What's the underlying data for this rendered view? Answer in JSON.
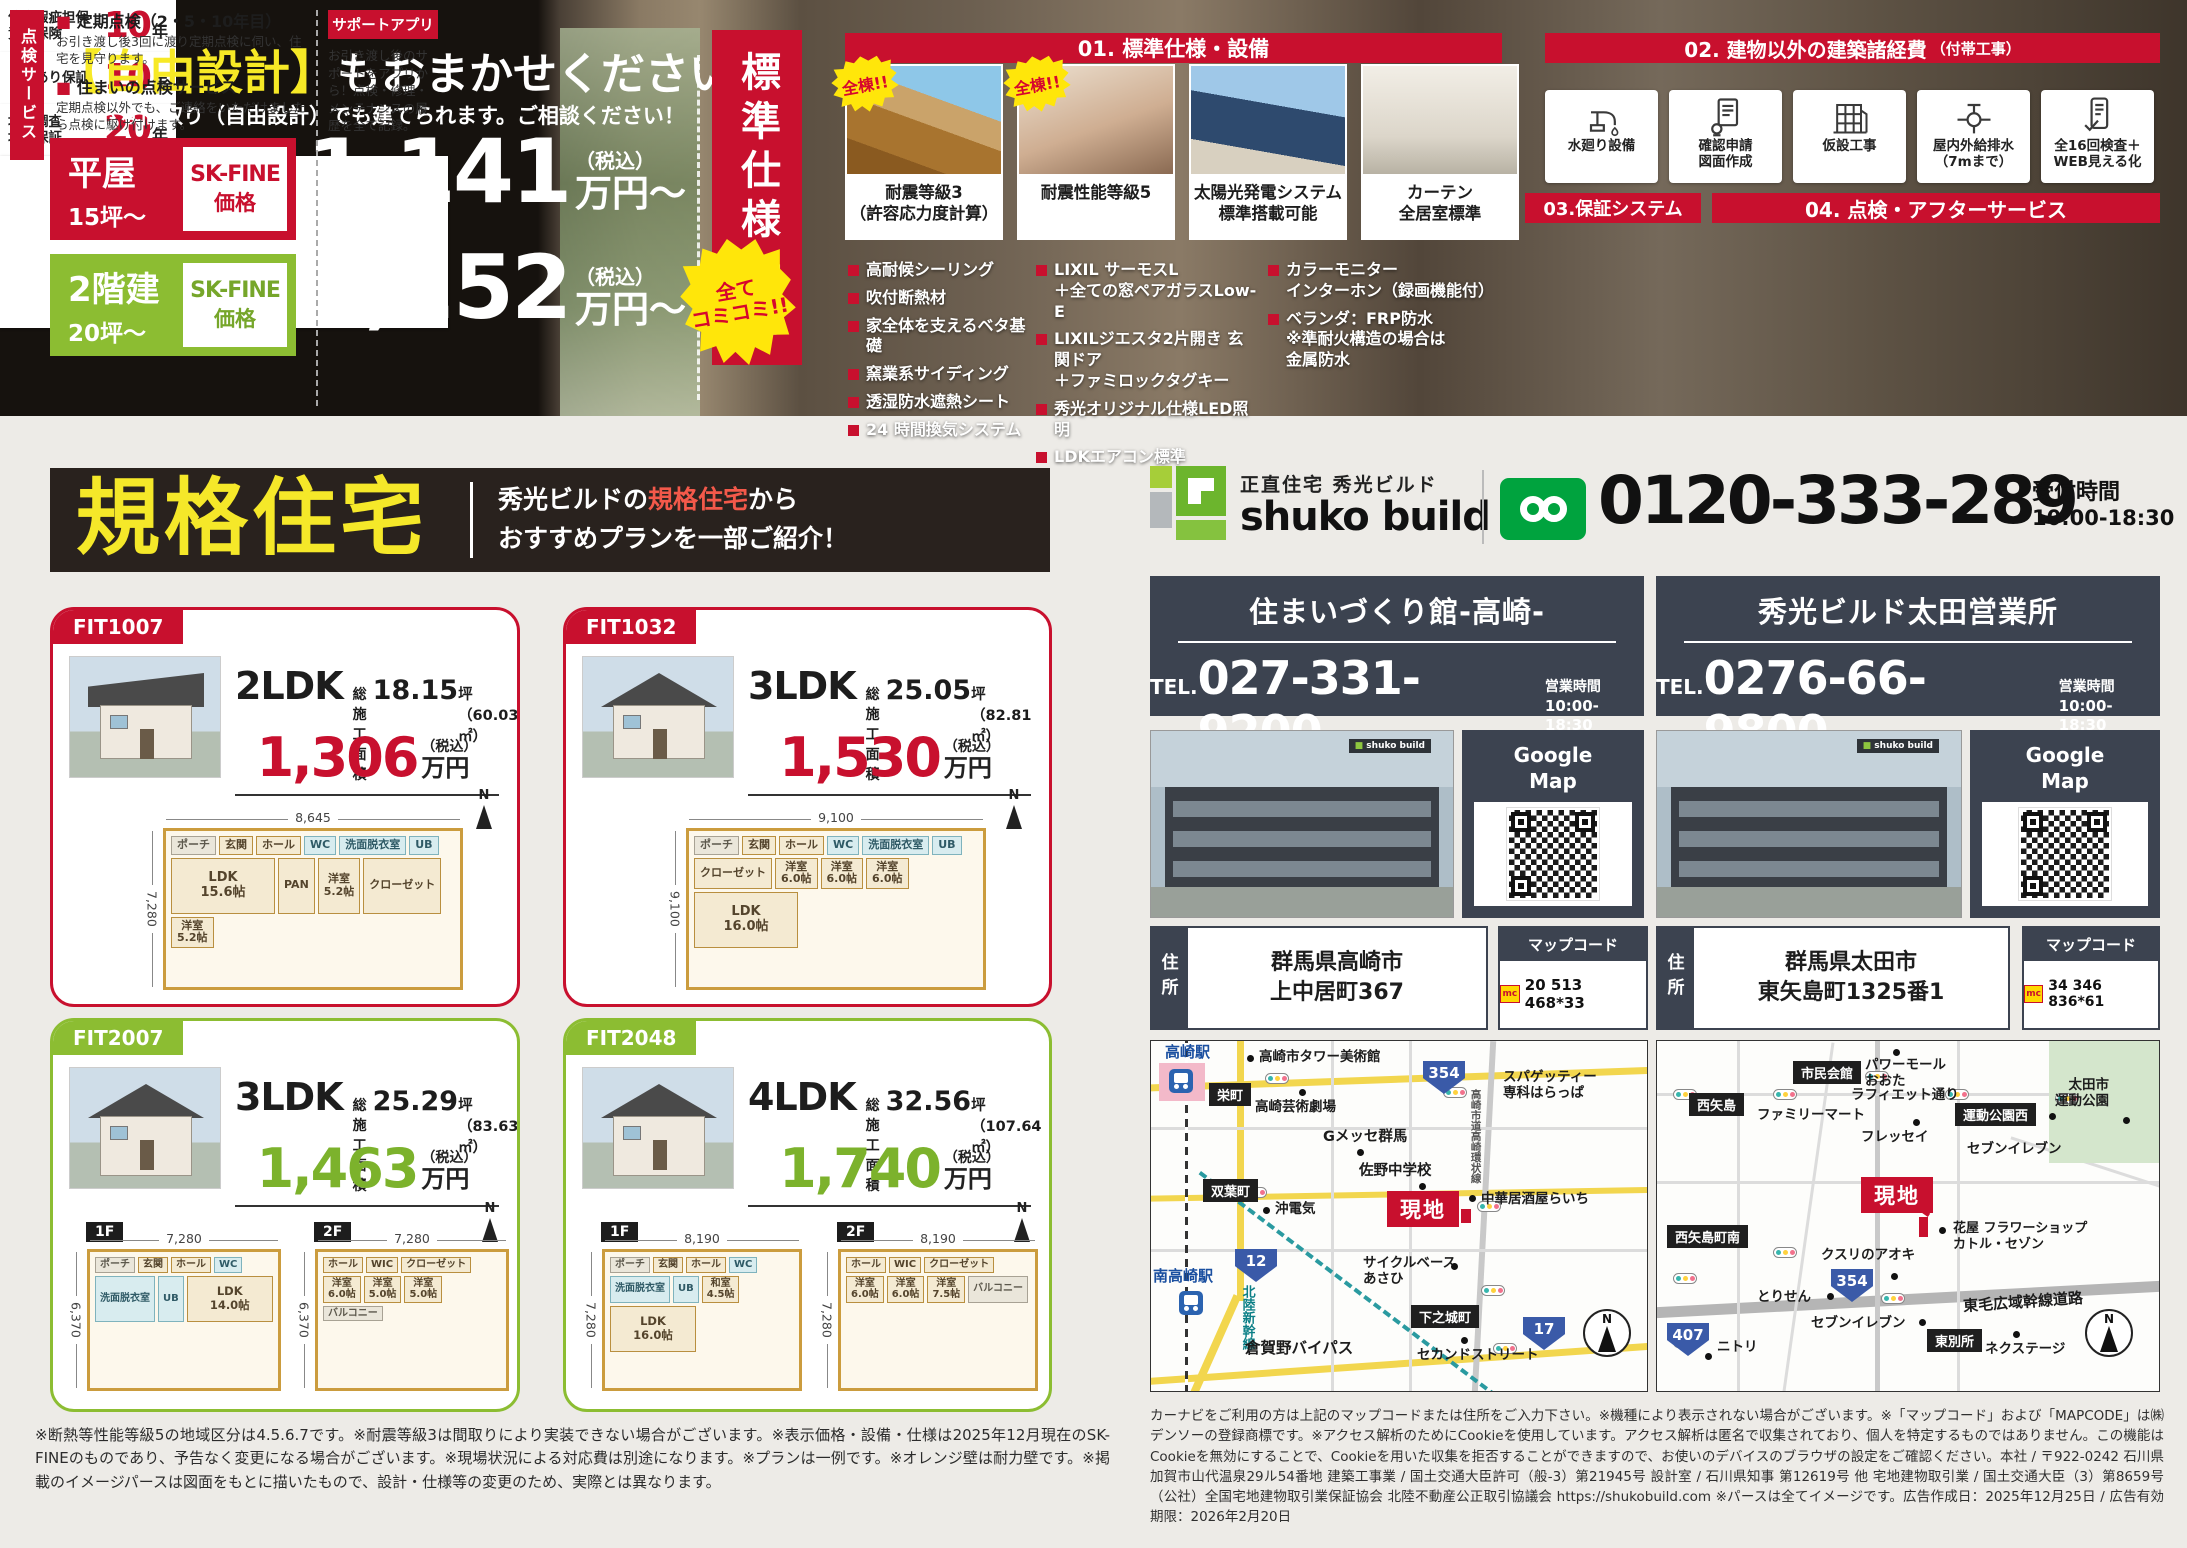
{
  "top": {
    "free_design": {
      "title_highlight": "【自由設計】",
      "title_rest": "もおまかせください。",
      "subtitle": "お好きな間取り（自由設計）でも建てられます。ご相談ください！",
      "rows": [
        {
          "name": "平屋",
          "size": "15坪〜",
          "badge": "SK-FINE",
          "badge_sub": "価格",
          "price": "1,141",
          "tax": "（税込）",
          "unit": "万円〜"
        },
        {
          "name": "2階建",
          "size": "20坪〜",
          "badge": "SK-FINE",
          "badge_sub": "価格",
          "price": "1,252",
          "tax": "（税込）",
          "unit": "万円〜"
        }
      ]
    },
    "std_banner": {
      "label": "標準仕様一覧",
      "bubble": "全て\nコミコミ!!"
    },
    "sec01": {
      "title": "01. 標準仕様・設備",
      "cards": [
        {
          "bubble": "全棟!!",
          "caption": "耐震等級3\n（許容応力度計算）"
        },
        {
          "bubble": "全棟!!",
          "caption": "耐震性能等級5"
        },
        {
          "caption": "太陽光発電システム\n標準搭載可能"
        },
        {
          "caption": "カーテン\n全居室標準"
        }
      ],
      "spec_columns": [
        [
          "高耐候シーリング",
          "吹付断熱材",
          "家全体を支えるベタ基礎",
          "窯業系サイディング",
          "透湿防水遮熱シート",
          "24 時間換気システム"
        ],
        [
          "LIXIL サーモスL\n＋全ての窓ペアガラスLow-E",
          "LIXILジエスタ2片開き 玄関ドア\n＋ファミロックタグキー",
          "秀光オリジナル仕様LED照明",
          "LDKエアコン標準"
        ],
        [
          "カラーモニター\nインターホン（録画機能付）",
          "ベランダ：FRP防水\n※準耐火構造の場合は\n金属防水"
        ]
      ]
    },
    "sec02": {
      "title": "02. 建物以外の建築諸経費",
      "title_sub": "（付帯工事）",
      "items": [
        {
          "icon": "faucet-icon",
          "label": "水廻り設備"
        },
        {
          "icon": "blueprint-icon",
          "label": "確認申請\n図面作成"
        },
        {
          "icon": "scaffold-icon",
          "label": "仮設工事"
        },
        {
          "icon": "plumbing-icon",
          "label": "屋内外給排水\n（7mまで）"
        },
        {
          "icon": "inspection-icon",
          "label": "全16回検査＋\nWEB見える化"
        }
      ]
    },
    "sec03": {
      "title": "03.保証システム",
      "rows": [
        {
          "label": "住宅瑕疵担保\n責任保険",
          "years": "10",
          "unit": "年"
        },
        {
          "label": "しろあり保証",
          "years": "10",
          "unit": "年"
        },
        {
          "label": "地盤調査\n地盤保証",
          "years": "20",
          "unit": "年"
        }
      ]
    },
    "sec04": {
      "title": "04. 点検・アフターサービス",
      "vertical_label": "点検サービス",
      "item1_title": "定期点検（2・5・10年目）",
      "item1_desc": "お引き渡し後3回に渡り定期点検に伺い、住宅を見守ります。",
      "item2_title": "住まいの点検サービス",
      "item2_desc": "定期点検以外でも、ご連絡をいただけましたら点検に駆け付けます。",
      "app_badge": "サポートアプリ",
      "app_desc": "お引き渡し後のサポートをアプリから！点検・修理・メンテナンスの履歴を全て記録。"
    }
  },
  "kikaku": {
    "title": "規格住宅",
    "desc_pre": "秀光ビルドの",
    "desc_highlight": "規格住宅",
    "desc_post": "から",
    "desc_line2": "おすすめプランを一部ご紹介！"
  },
  "plans": [
    {
      "code": "FIT1007",
      "ldk": "2LDK",
      "area_label": "総施工面積",
      "area_value": "18.15",
      "area_unit": "坪（60.03㎡）",
      "price": "1,306",
      "tax": "（税込）",
      "unit": "万円",
      "floors": [
        {
          "name": "",
          "width": "8,645",
          "height": "7,280",
          "rooms": [
            "ポーチ",
            "玄関",
            "ホール",
            "WC",
            "洗面脱衣室",
            "UB",
            "LDK\n15.6帖",
            "PAN",
            "洋室\n5.2帖",
            "クローゼット",
            "洋室\n5.2帖"
          ]
        }
      ]
    },
    {
      "code": "FIT1032",
      "ldk": "3LDK",
      "area_label": "総施工面積",
      "area_value": "25.05",
      "area_unit": "坪（82.81㎡）",
      "price": "1,530",
      "tax": "（税込）",
      "unit": "万円",
      "floors": [
        {
          "name": "",
          "width": "9,100",
          "height": "9,100",
          "rooms": [
            "ポーチ",
            "玄関",
            "ホール",
            "WC",
            "洗面脱衣室",
            "UB",
            "クローゼット",
            "洋室\n6.0帖",
            "洋室\n6.0帖",
            "洋室\n6.0帖",
            "LDK\n16.0帖"
          ]
        }
      ]
    },
    {
      "code": "FIT2007",
      "ldk": "3LDK",
      "area_label": "総施工面積",
      "area_value": "25.29",
      "area_unit": "坪（83.63㎡）",
      "price": "1,463",
      "tax": "（税込）",
      "unit": "万円",
      "floors": [
        {
          "name": "1F",
          "width": "7,280",
          "height": "6,370",
          "rooms": [
            "ポーチ",
            "玄関",
            "ホール",
            "WC",
            "洗面脱衣室",
            "UB",
            "LDK\n14.0帖"
          ]
        },
        {
          "name": "2F",
          "width": "7,280",
          "height": "6,370",
          "rooms": [
            "ホール",
            "WIC",
            "クローゼット",
            "洋室\n6.0帖",
            "洋室\n5.0帖",
            "洋室\n5.0帖",
            "バルコニー"
          ]
        }
      ]
    },
    {
      "code": "FIT2048",
      "ldk": "4LDK",
      "area_label": "総施工面積",
      "area_value": "32.56",
      "area_unit": "坪（107.64㎡）",
      "price": "1,740",
      "tax": "（税込）",
      "unit": "万円",
      "floors": [
        {
          "name": "1F",
          "width": "8,190",
          "height": "7,280",
          "rooms": [
            "ポーチ",
            "玄関",
            "ホール",
            "WC",
            "洗面脱衣室",
            "UB",
            "和室\n4.5帖",
            "LDK\n16.0帖"
          ]
        },
        {
          "name": "2F",
          "width": "8,190",
          "height": "7,280",
          "rooms": [
            "ホール",
            "WIC",
            "クローゼット",
            "洋室\n6.0帖",
            "洋室\n6.0帖",
            "洋室\n7.5帖",
            "バルコニー"
          ]
        }
      ]
    }
  ],
  "fineprint_left": "※断熱等性能等級5の地域区分は4.5.6.7です。※耐震等級3は間取りにより実装できない場合がございます。※表示価格・設備・仕様は2025年12月現在のSK-FINEのものであり、予告なく変更になる場合がございます。※現場状況による対応費は別途になります。※プランは一例です。※オレンジ壁は耐力壁です。※掲載のイメージパースは図面をもとに描いたもので、設計・仕様等の変更のため、実際とは異なります。",
  "contact": {
    "tagline": "正直住宅 秀光ビルド",
    "brand": "shuko build",
    "phone": "0120-333-289",
    "hours_label": "受付時間",
    "hours": "10:00-18:30"
  },
  "offices": [
    {
      "name": "住まいづくり館-高崎-",
      "tel_label": "TEL.",
      "tel": "027-331-9200",
      "hours_label": "営業時間",
      "hours": "10:00-18:30",
      "gmap_label": "Google\nMap",
      "addr_label": "住所",
      "address": "群馬県高崎市\n上中居町367",
      "mapcode_label": "マップコード",
      "mapcode": "20 513 468*33"
    },
    {
      "name": "秀光ビルド太田営業所",
      "tel_label": "TEL.",
      "tel": "0276-66-9800",
      "hours_label": "営業時間",
      "hours": "10:00-18:30",
      "gmap_label": "Google\nMap",
      "addr_label": "住所",
      "address": "群馬県太田市\n東矢島町1325番1",
      "mapcode_label": "マップコード",
      "mapcode": "34 346 836*61"
    }
  ],
  "maps": {
    "takasaki": {
      "station_main": "高崎駅",
      "sakaecho": "栄町",
      "tower_museum": "高崎市タワー美術館",
      "theater": "高崎芸術劇場",
      "spaghetti": "スパゲッティー\n専科はらっぱ",
      "ring_road": "高崎市道高崎環状線",
      "gmesse": "Gメッセ群馬",
      "sano_school": "佐野中学校",
      "futabacho": "双葉町",
      "oki_denki": "沖電気",
      "raichi": "中華居酒屋らいち",
      "station_south": "南高崎駅",
      "shinkansen": "北陸新幹線",
      "cycle_asahi": "サイクルベース\nあさひ",
      "shimonojo": "下之城町",
      "kuragano_bypass": "倉賀野バイパス",
      "second_street": "セカンドストリート",
      "route_354": "354",
      "route_12": "12",
      "route_17": "17",
      "genchi": "現地",
      "compass": "N"
    },
    "ota": {
      "nishiyajima": "西矢島",
      "civic_hall": "市民会館",
      "power_mall": "パワーモール\nおおた",
      "lafayette_st": "ラフィエット通り",
      "familymart": "ファミリーマート",
      "park_west": "運動公園西",
      "ota_park": "太田市\n運動公園",
      "fressay": "フレッセイ",
      "seven_north": "セブンイレブン",
      "flower_shop": "花屋 フラワーショップ\nカトル・セゾン",
      "nishiyajima_south": "西矢島町南",
      "aoki_pharmacy": "クスリのアオキ",
      "torisen": "とりせん",
      "seven_south": "セブンイレブン",
      "higashi_bessho": "東別所",
      "tomo_highway": "東毛広域幹線道路",
      "nextage": "ネクステージ",
      "nitori": "ニトリ",
      "route_354": "354",
      "route_407": "407",
      "genchi": "現地",
      "compass": "N"
    }
  },
  "fineprint_right": "カーナビをご利用の方は上記のマップコードまたは住所をご入力下さい。※機種により表示されない場合がございます。※「マップコード」および「MAPCODE」は㈱デンソーの登録商標です。※アクセス解析のためにCookieを使用しています。アクセス解析は匿名で収集されており、個人を特定するものではありません。この機能はCookieを無効にすることで、Cookieを用いた収集を拒否することができますので、お使いのデバイスのブラウザの設定をご確認ください。本社 / 〒922-0242 石川県加賀市山代温泉29ル54番地 建築工事業 / 国土交通大臣許可（般-3）第21945号 設計室 / 石川県知事 第12619号 他 宅地建物取引業 / 国土交通大臣（3）第8659号（公社）全国宅地建物取引業保証協会 北陸不動産公正取引協議会 https://shukobuild.com ※パースは全てイメージです。広告作成日：2025年12月25日 / 広告有効期限：2026年2月20日"
}
